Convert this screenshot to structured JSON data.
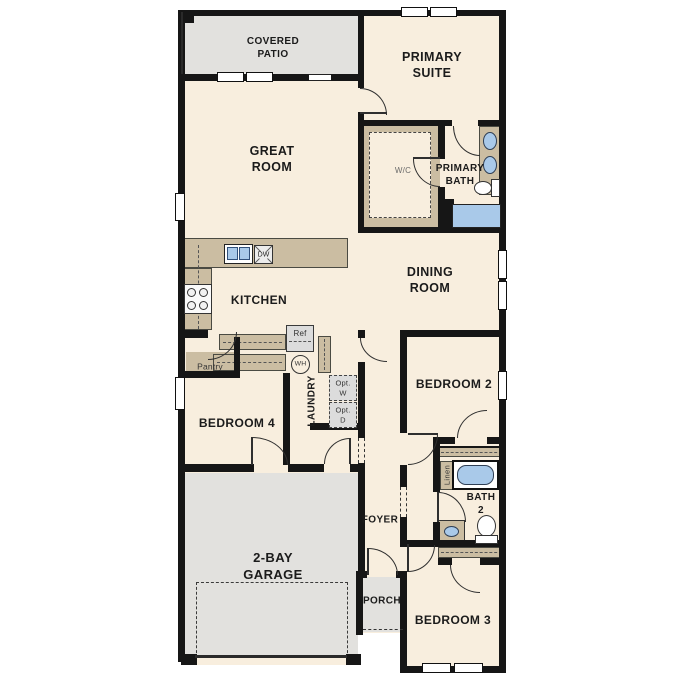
{
  "rooms": {
    "covered_patio": "COVERED\nPATIO",
    "primary_suite": "PRIMARY\nSUITE",
    "great_room": "GREAT\nROOM",
    "wic": "W/C",
    "primary_bath": "PRIMARY\nBATH",
    "kitchen": "KITCHEN",
    "dining_room": "DINING\nROOM",
    "pantry": "Pantry",
    "laundry": "LAUNDRY",
    "bedroom_4": "BEDROOM 4",
    "bedroom_2": "BEDROOM 2",
    "bath_2": "BATH\n2",
    "linen": "Linen",
    "foyer": "FOYER",
    "garage": "2-BAY\nGARAGE",
    "porch": "PORCH",
    "bedroom_3": "BEDROOM 3"
  },
  "fixtures": {
    "dishwasher": "DW",
    "refrigerator": "Ref",
    "water_heater": "WH",
    "optional_washer": "Opt.\nW",
    "optional_dryer": "Opt.\nD"
  },
  "colors": {
    "room_fill": "#f8eede",
    "outdoor_fill": "#e2e1de",
    "counter_fill": "#cbbda2",
    "appliance_fill": "#dcdcdc",
    "water_fixture_fill": "#a9c9e9",
    "wall": "#161616"
  }
}
